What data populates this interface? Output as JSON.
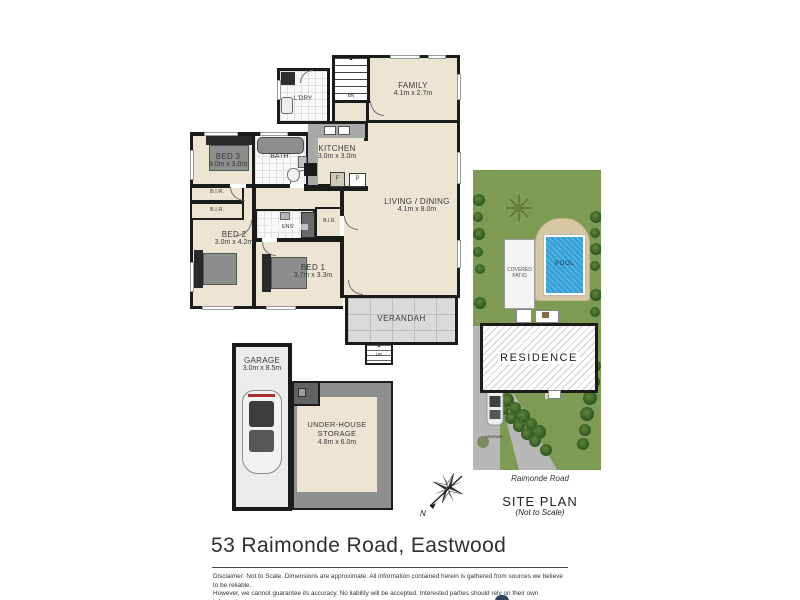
{
  "page": {
    "address_title": "53 Raimonde Road, Eastwood",
    "disclaimer_line1": "Disclaimer: Not to Scale. Dimensions are approximate. All information contained herein is gathered from sources we believe to be reliable.",
    "disclaimer_line2": "However, we cannot guarantee its accuracy. No liability will be accepted. Interested parties should rely on their own information."
  },
  "floor_plan": {
    "family": {
      "name": "FAMILY",
      "dims": "4.1m x 2.7m"
    },
    "laundry": {
      "name": "L'DRY"
    },
    "stairs_down_label": "DN",
    "stairs_up_label": "UP",
    "bed3": {
      "name": "BED 3",
      "dims": "3.0m x 3.0m"
    },
    "bath": {
      "name": "BATH'"
    },
    "kitchen": {
      "name": "KITCHEN",
      "dims": "3.0m x 3.0m"
    },
    "living_dining": {
      "name": "LIVING / DINING",
      "dims": "4.1m x 8.0m"
    },
    "bed2": {
      "name": "BED 2",
      "dims": "3.0m x 4.2m"
    },
    "ensuite": {
      "name": "ENS'"
    },
    "bed1": {
      "name": "BED 1",
      "dims": "3.7m x 3.3m"
    },
    "built_in_robe": "B.I.R.",
    "fridge": "F",
    "pantry": "P",
    "verandah": {
      "name": "VERANDAH"
    },
    "garage": {
      "name": "GARAGE",
      "dims": "3.0m x 8.5m"
    },
    "under_house_storage": {
      "name_line1": "UNDER-HOUSE",
      "name_line2": "STORAGE",
      "dims": "4.8m x 6.0m"
    }
  },
  "site_plan": {
    "pool_label": "POOL",
    "patio_line1": "COVERED",
    "patio_line2": "PATIO",
    "residence_label": "RESIDENCE",
    "driveway_label": "DRIVEWAY",
    "road_label": "Raimonde Road",
    "title": "SITE PLAN",
    "subtitle": "(Not to Scale)"
  },
  "compass": {
    "north_label": "N"
  },
  "colors": {
    "wall": "#1b1b1b",
    "floor": "#ece5d3",
    "grass": "#7d9b52",
    "pool_water": "#2f9fd6",
    "paving": "#d8c7a3",
    "driveway": "#b7b7b7"
  }
}
